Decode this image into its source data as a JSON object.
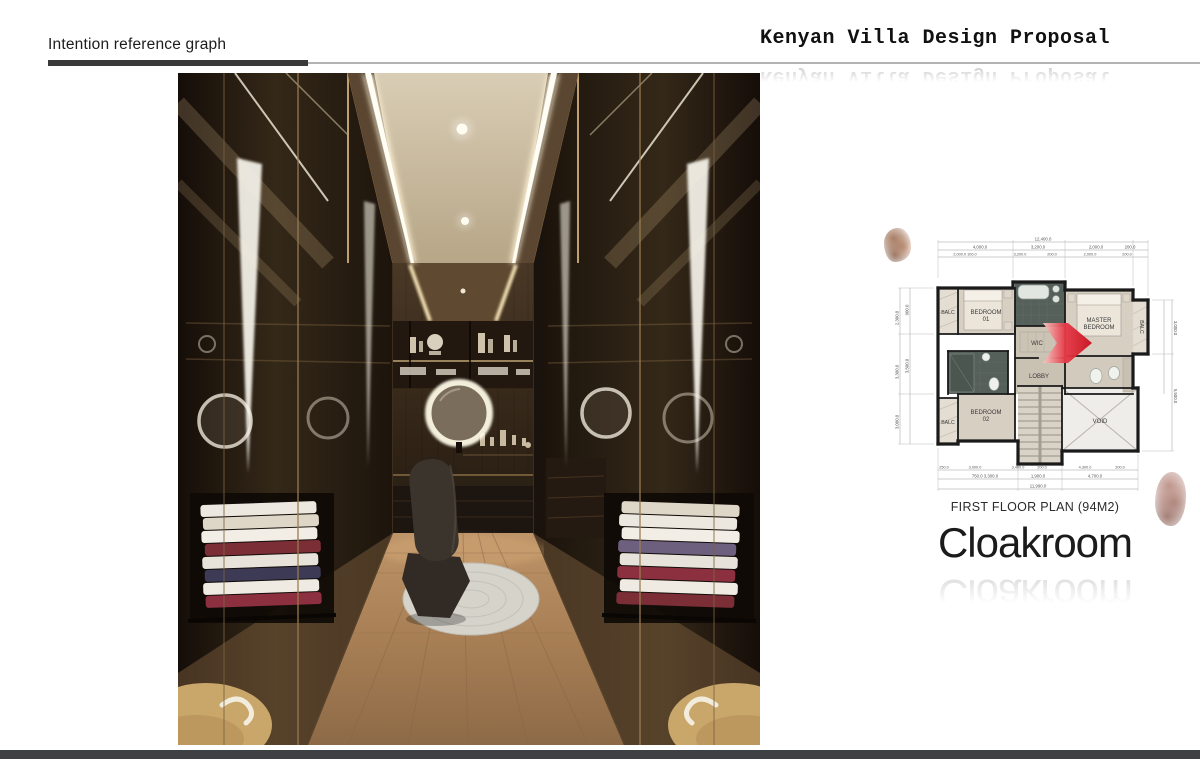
{
  "page": {
    "background": "#ffffff",
    "footer_bar_color": "#3e4143",
    "underline_bar_color": "#3a3a3a"
  },
  "header": {
    "section_label": "Intention reference graph",
    "title": "Kenyan Villa Design Proposal"
  },
  "render": {
    "subject": "walk-in cloakroom interior 3d render",
    "palette": {
      "glass": "#2b2117",
      "ceiling": "#cfc2a9",
      "cove_light": "#fff3d6",
      "floor_wood": "#ab8259",
      "rug": "#d6d3cb",
      "ottoman": "#c9a66a"
    }
  },
  "plan": {
    "caption": "FIRST FLOOR PLAN (94M2)",
    "room_title": "Cloakroom",
    "arrow_color": "#dd1823",
    "rooms": {
      "balc_top_left": "BALC",
      "bedroom1_line1": "BEDROOM",
      "bedroom1_line2": "01",
      "master_line1": "MASTER",
      "master_line2": "BEDROOM",
      "balc_right": "BALC",
      "wic": "WIC",
      "lobby": "LOBBY",
      "bedroom2_line1": "BEDROOM",
      "bedroom2_line2": "02",
      "balc_bottom_left": "BALC",
      "void": "VOID"
    },
    "dims": {
      "top_total": "12,400.0",
      "top_row": [
        "4,000.0",
        "3,200.0",
        "2,000.0",
        "200.0"
      ],
      "top_row2": [
        "2,000.0 100.0",
        "3,200.0",
        "200.0",
        "2,000.0",
        "200.0"
      ],
      "bottom_row": [
        "250.0",
        "3,000.0",
        "3,400.0",
        "200.0",
        "4,300.0",
        "200.0"
      ],
      "bottom_row2": [
        "750.0 3,300.0",
        "1,900.0",
        "4,700.0"
      ],
      "bottom_total": "11,990.0",
      "left_col": [
        "2,300.0",
        "3,300.0",
        "3,000.0"
      ],
      "left_col2": [
        "900.0",
        "3,500.0"
      ],
      "right_col": [
        "3,000.0",
        "5,500.0"
      ]
    }
  }
}
